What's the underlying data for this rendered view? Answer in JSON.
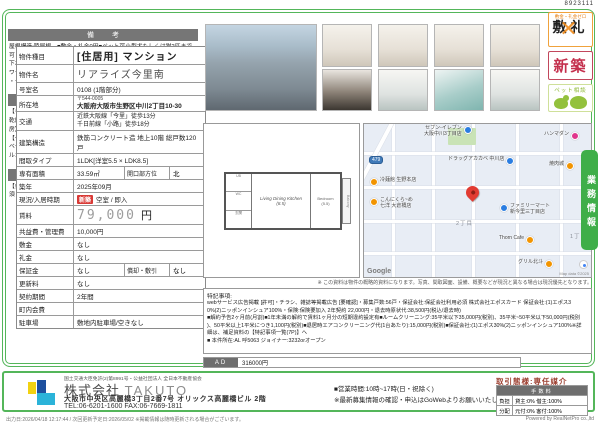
{
  "doc_number": "8923111",
  "property_table": {
    "rows": [
      {
        "label": "物件種目",
        "value": "[住居用] マンション"
      },
      {
        "label": "物件名",
        "value": "リアライズ今里南"
      },
      {
        "label": "号室名",
        "value": "0108 (1階部分)"
      },
      {
        "label": "所在地",
        "postal": "〒544-0005",
        "value": "大阪府大阪市生野区中川2丁目10-30"
      },
      {
        "label": "交通",
        "line1": "近鉄大阪線「今里」徒歩13分",
        "line2": "千日前線「小路」徒歩18分"
      },
      {
        "label": "建築構造",
        "value": "鉄筋コンクリート造 地上10階 総戸数120戸"
      },
      {
        "label": "間取タイプ",
        "value": "1LDK[洋室5.5 × LDK8.5]"
      },
      {
        "label": "専有面積",
        "value": "33.59㎡",
        "label2": "開口部方位",
        "value2": "北"
      },
      {
        "label": "築年",
        "value": "2025年09月"
      },
      {
        "label": "現況/入居時期",
        "badge": "新築",
        "value": "空室 / 即入"
      },
      {
        "label": "賃料",
        "value": "79,000",
        "unit": "円"
      },
      {
        "label": "共益費・管理費",
        "value": "10,000円"
      },
      {
        "label": "敷金",
        "value": "なし"
      },
      {
        "label": "礼金",
        "value": "なし"
      },
      {
        "label": "保証金",
        "value": "なし",
        "label2": "償却・敷引",
        "value2": "なし"
      },
      {
        "label": "更新料",
        "value": "なし"
      },
      {
        "label": "契約期間",
        "value": "2年間"
      },
      {
        "label": "町内会費",
        "value": ""
      },
      {
        "label": "駐車場",
        "value": "敷地内駐車場/空きなし"
      }
    ]
  },
  "sections": {
    "remarks_title": "備 考",
    "remarks_text": "屋根構造:陸屋根、■敷金・礼金0円■ペット可小型犬もしくは猫2匹まで可\n下水道・グリル・冷房・ダブルロックドア・人感センサー付照明・シャワー\n・クローゼット・クッションフロア",
    "equipment_title": "設 備",
    "equipment_text": "【キッチン】給湯器・システムキッチン 【水回り】洗面台(独立)・浴室乾燥機・洗髪洗面化粧台・バス・トイレ別・洗濯機置場(室内) 【冷暖房】エアコン 【収納】シューズボックス 【放送・通信】ケーブルTV 【セキュリティ】オートロック・宅配BOX・防犯カメラ 【その他】エレベーター・オートバイ駐輪場・自転車置場・電気・ガス(都市ガス)・バルコニー/ベランダ・フローリング",
    "conditions_title": "条 件",
    "conditions_text": "【条件】ペット相談・外国人契約可能・2人入居可能・保証会社利用必須"
  },
  "stamps": {
    "zero_title": "敷金・礼金ゼロ",
    "zero_chars": "敷礼",
    "zero_cross": "✕",
    "new_label": "新築",
    "pet_label": "ペット相談"
  },
  "floor_plan": {
    "ldk": "Living Dining Kitchen",
    "ldk_size": "(8.5)",
    "bedroom": "Bedroom",
    "bedroom_size": "(5.5)",
    "balcony": "Balcony",
    "bath": "UB",
    "toilet": "WC",
    "entry": "玄関"
  },
  "map": {
    "pois": [
      {
        "name": "セブン-イレブン\n大阪中川3丁目店",
        "color": "#2a7de1"
      },
      {
        "name": "ハンマダン",
        "color": "#e0368c"
      },
      {
        "name": "ドラッグアカカベ 中川店",
        "color": "#2a7de1"
      },
      {
        "name": "冷麺館 生野本店",
        "color": "#f29400"
      },
      {
        "name": "こんにくら~め\n七洋 大倉橋店",
        "color": "#f29400"
      },
      {
        "name": "焼肉城",
        "color": "#f29400"
      },
      {
        "name": "ファミリーマート\n新今里三丁目店",
        "color": "#2a7de1"
      },
      {
        "name": "Thorn Cafe",
        "color": "#f29400"
      },
      {
        "name": "グリル北斗",
        "color": "#f29400"
      }
    ],
    "areas": [
      "2丁目",
      "1丁目"
    ],
    "route_badge": "479",
    "logo": "Google",
    "credit": "Map data ©2025"
  },
  "biz_tab": "業務情報",
  "special_notes": {
    "disclaimer": "※ この資料は物件の概略的資料になります。写真、間取図面、設備、概要などが現況と異なる場合は現況優先となります。",
    "title": "特記事項:",
    "body": "webサービス広告掲載 [許可]・チラシ、雑誌等掲載広告 [要確認]・募集戸数:56戸・保証会社:保証会社利用必須 株式会社エポスカード 保証会社:(1)エポス3\n0%(2)ニッポンインシュア100%・保険:保険要加入 2年契約 22,000円・退去時原状代:38,500円(税込/退去時)\n■解約予告2ヶ月前(月割)■1年未満の解約で賃料1ヶ月分の短期違約設定有■ルームクリーニング:35平米以下35,000円(税別)、35平米~50平米以下50,000円(税別\n)、50平米以上1平米につき1,100円(税別)■退居時エアコンクリーニング代(1台あたり):15,000円(税別)■保証会社:(1)エポス30%(2)ニッポンインシュア100%※詳\n細は、補足資料の【特記事項一覧(7P)】へ\n■ 本件所在:AL 呼5063 ジョイナー:3232orオープン"
  },
  "ad": {
    "label": "AD",
    "value": "316000円"
  },
  "footer": {
    "license": "国土交通大臣免許(2)第8991号・公益社団法人 全日本不動産協会",
    "company_jp": "株式会社",
    "company_en": "TAKUTO",
    "address": "大阪市中央区高麗橋3丁目2番7号 オリックス高麗橋ビル 2階",
    "telfax": "TEL:06-6201-1600 FAX:06-7669-1811",
    "hours": "■営業時間:10時~17時(日・祝除く)",
    "note": "※最新募集情報の確認・申込はGoWebよりお願いいたします。",
    "deal_type": "取引態様:専任媒介",
    "fee_table": {
      "title": "手数料",
      "r1_label": "負担",
      "r1_value": "貸主:0% 借主:100%",
      "r2_label": "分配",
      "r2_value": "元付:0% 客付:100%"
    }
  },
  "bottom": {
    "output": "出力日:2026/04/18 12:17:44 / 次回更新予定日:2026/05/02 ※掲載情報は随時更新される場合がございます。",
    "powered": "Powered by RealNetPro co.,ltd"
  }
}
